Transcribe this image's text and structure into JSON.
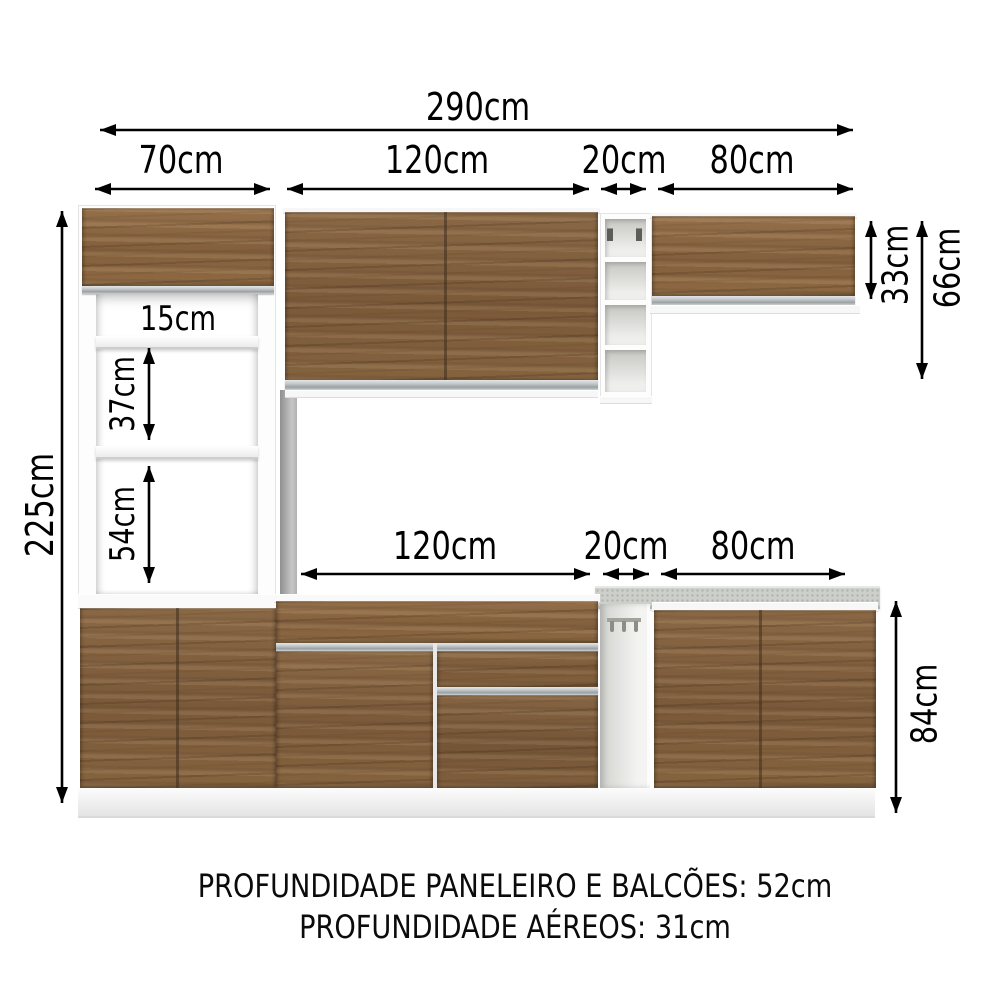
{
  "labels": {
    "w290": "290cm",
    "w70": "70cm",
    "w120_top": "120cm",
    "w20_top": "20cm",
    "w80_top": "80cm",
    "h225": "225cm",
    "n15": "15cm",
    "n37": "37cm",
    "n54": "54cm",
    "h33": "33cm",
    "h66": "66cm",
    "w120_mid": "120cm",
    "w20_mid": "20cm",
    "w80_mid": "80cm",
    "h84": "84cm"
  },
  "footer": {
    "line1": "PROFUNDIDADE PANELEIRO E BALCÕES: 52cm",
    "line2": "PROFUNDIDADE AÉREOS: 31cm"
  },
  "colors": {
    "wood": "#7f5f3e",
    "aluminum_handle": "#b9bec0",
    "countertop": "#cdd0ca",
    "cabinet_body": "#ffffff",
    "arrow": "#000000"
  }
}
